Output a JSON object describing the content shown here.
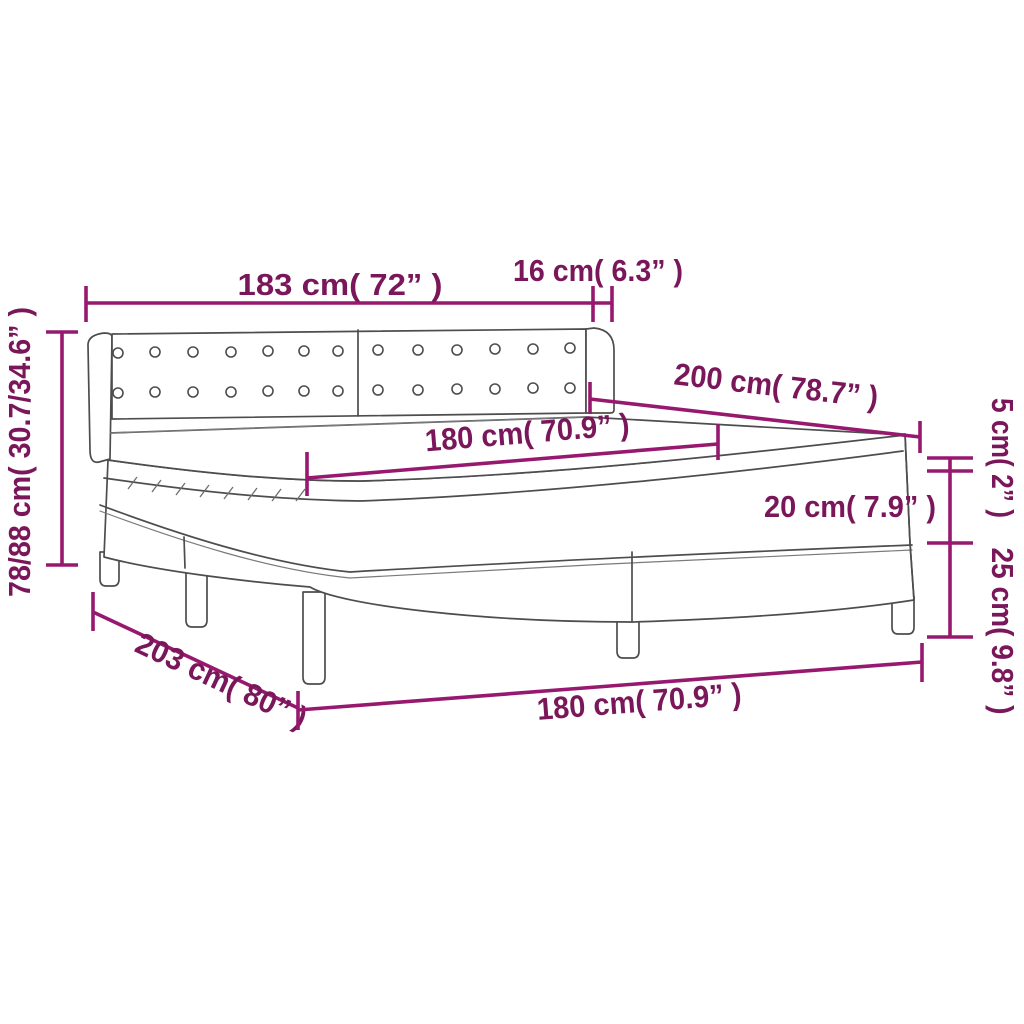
{
  "diagram": {
    "kind": "product-dimension-diagram",
    "subject": "box spring bed with tufted headboard, mattress and topper",
    "units": "cm (inches)",
    "colors": {
      "dimension_text": "#7A175A",
      "dimension_line": "#97196F",
      "drawing_line": "#4D4D4D",
      "background": "#FFFFFF"
    },
    "dims": {
      "headboard_width": "183 cm( 72” )",
      "headboard_wing_depth": "16 cm( 6.3” )",
      "bed_length": "200 cm( 78.7” )",
      "mattress_width": "180 cm( 70.9” )",
      "mattress_height": "20 cm( 7.9” )",
      "topper_height": "5 cm( 2” )",
      "base_height": "25 cm( 9.8” )",
      "headboard_height_range": "78/88 cm( 30.7/34.6” )",
      "total_length": "203 cm( 80” )",
      "base_width": "180 cm( 70.9” )"
    }
  }
}
